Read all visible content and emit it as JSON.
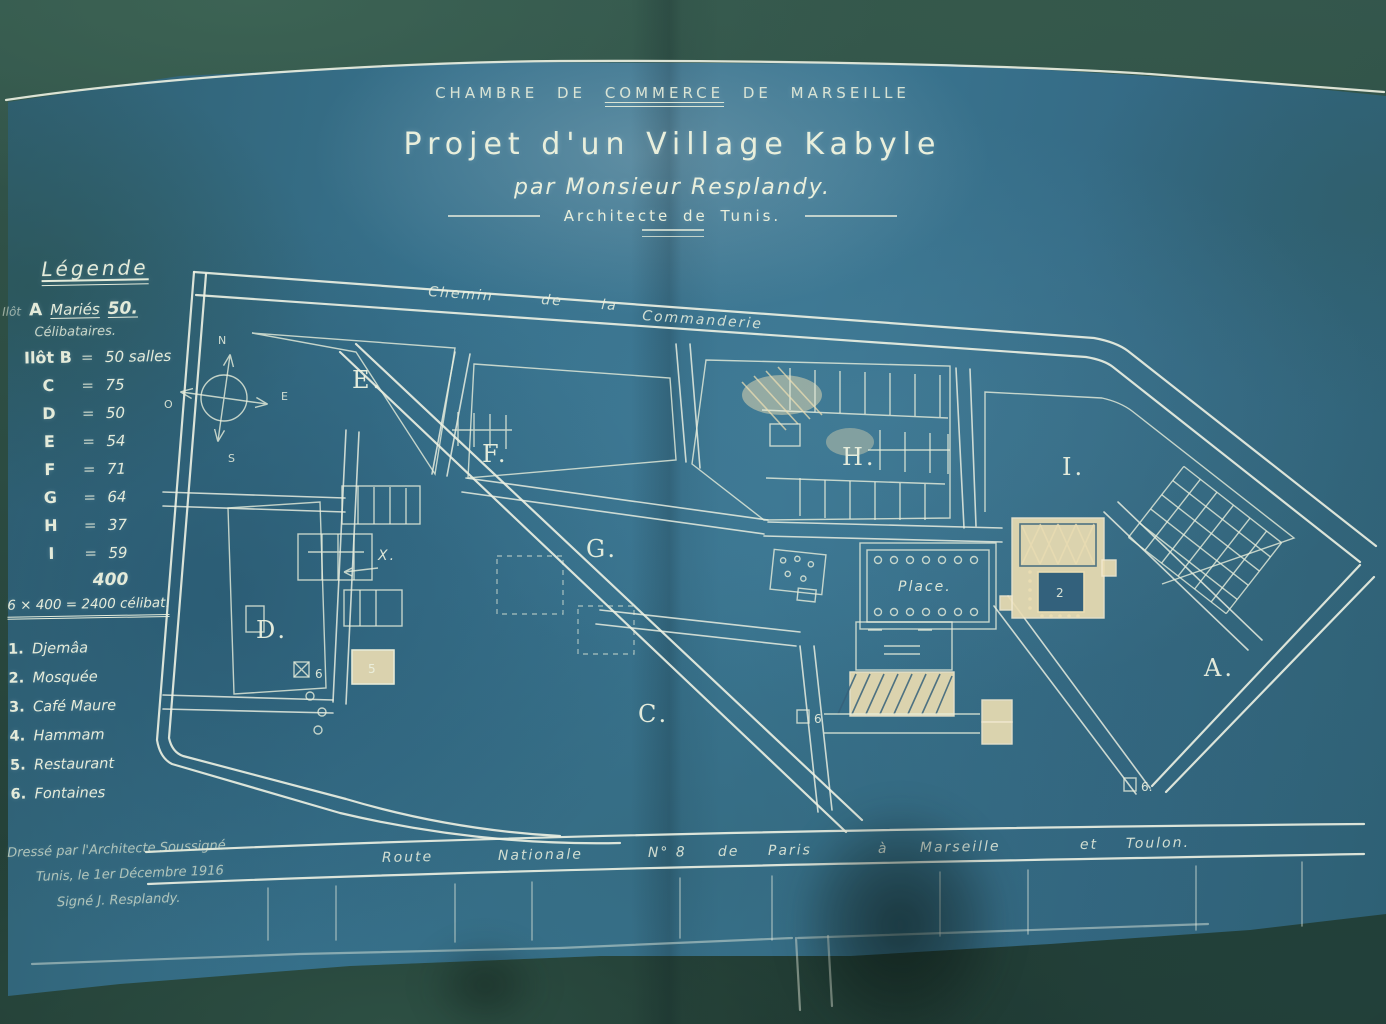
{
  "palette": {
    "paper_blue": "#37718c",
    "photo_green": "#2c4c42",
    "line_white": "#eef2e3",
    "building_cream": "#e9dcb2"
  },
  "header": {
    "org_1": "CHAMBRE DE",
    "org_2": "COMMERCE",
    "org_3": "DE MARSEILLE",
    "title": "Projet d'un Village Kabyle",
    "byline": "par Monsieur Resplandy.",
    "subtitle": "Architecte de Tunis."
  },
  "legend": {
    "heading": "Légende",
    "ilot_prefix": "Ilôt",
    "ilot_letter": "A",
    "ilot_word": "Mariés",
    "ilot_value": "50.",
    "subhead": "Célibataires.",
    "eq": "=",
    "rows": [
      {
        "label": "Ilôt B",
        "value": "50 salles"
      },
      {
        "label": "C",
        "value": "75"
      },
      {
        "label": "D",
        "value": "50"
      },
      {
        "label": "E",
        "value": "54"
      },
      {
        "label": "F",
        "value": "71"
      },
      {
        "label": "G",
        "value": "64"
      },
      {
        "label": "H",
        "value": "37"
      },
      {
        "label": "I",
        "value": "59"
      }
    ],
    "total": "400",
    "formula": "6 × 400 = 2400 célibat.",
    "items": [
      {
        "num": "1.",
        "label": "Djemâa"
      },
      {
        "num": "2.",
        "label": "Mosquée"
      },
      {
        "num": "3.",
        "label": "Café Maure"
      },
      {
        "num": "4.",
        "label": "Hammam"
      },
      {
        "num": "5.",
        "label": "Restaurant"
      },
      {
        "num": "6.",
        "label": "Fontaines"
      }
    ]
  },
  "map": {
    "top_road_words": [
      "Chemin",
      "de",
      "la",
      "Commanderie"
    ],
    "bottom_road_words": [
      "Route",
      "Nationale",
      "N° 8",
      "de",
      "Paris",
      "à",
      "Marseille",
      "et",
      "Toulon."
    ],
    "blocks": [
      "E.",
      "F.",
      "G.",
      "H.",
      "I.",
      "D.",
      "C.",
      "A."
    ],
    "place_label": "Place.",
    "x_label": "X.",
    "restaurant_num": "5",
    "mosque_num": "2",
    "fountain_nums": [
      "6",
      "6",
      "6."
    ],
    "compass": {
      "n": "N",
      "s": "S",
      "e": "E",
      "o": "O"
    }
  },
  "signature": {
    "line1": "Dressé par l'Architecte Soussigné.",
    "line2": "Tunis, le 1er Décembre 1916",
    "line3": "Signé J. Resplandy."
  }
}
